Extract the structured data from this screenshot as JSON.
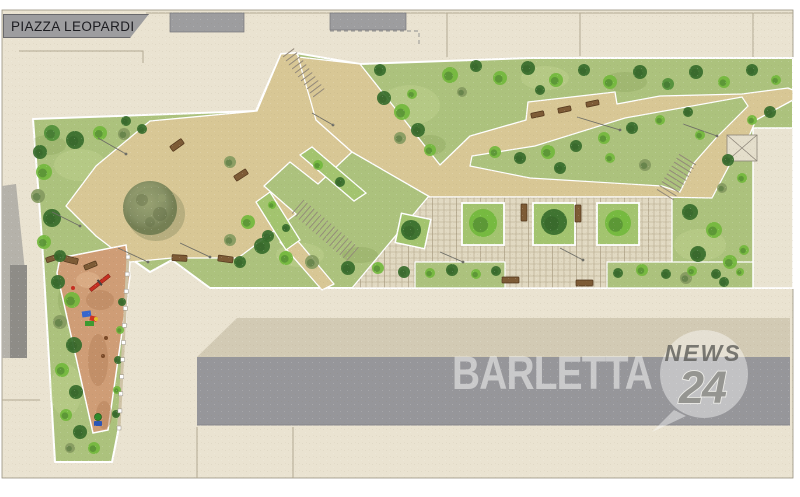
{
  "title": {
    "block_label": "PIAZZA LEOPARDI"
  },
  "watermark": {
    "brand": "BARLETTA",
    "bubble_top": "NEWS",
    "bubble_number": "24"
  },
  "colors": {
    "paper": "#eae3d1",
    "joint": "#b3a992",
    "building": "#9d9d9f",
    "building_light": "#b5b2aa",
    "building_dark": "#8e8c87",
    "band_gray": "#96969a",
    "roof_shade": "#d2cab4",
    "lawn": "#acc27d",
    "lawn_light": "#c6d795",
    "lawn_dark": "#8aa45c",
    "path": "#d8c795",
    "cobble": "#e1d9c2",
    "cobble_line": "#b6aa8d",
    "planter": "#a3c46f",
    "playground": "#cf9d76",
    "playground_dark": "#b5815a",
    "bench": "#7d5b36",
    "bench_dark": "#52371c",
    "tree_bright": "#72b93c",
    "tree_mid": "#4f8f38",
    "tree_dark": "#366d2b",
    "tree_olive": "#849a60",
    "tree_shadow": "#2f5a26",
    "big_tree": "#75865c",
    "parcel": "#e9e3d1",
    "wm_white": "#fafaf8",
    "wm_gray": "#5a5a56",
    "wm_num": "#8c8c86"
  },
  "map": {
    "trees": [
      [
        52,
        133,
        8,
        1
      ],
      [
        75,
        140,
        9,
        2
      ],
      [
        100,
        133,
        7,
        0
      ],
      [
        124,
        134,
        6,
        3
      ],
      [
        142,
        129,
        5,
        2
      ],
      [
        126,
        121,
        5,
        2
      ],
      [
        40,
        152,
        7,
        2
      ],
      [
        44,
        172,
        8,
        0
      ],
      [
        38,
        196,
        7,
        3
      ],
      [
        52,
        218,
        9,
        2
      ],
      [
        44,
        242,
        7,
        0
      ],
      [
        60,
        256,
        6,
        2
      ],
      [
        230,
        162,
        6,
        3
      ],
      [
        268,
        236,
        6,
        2
      ],
      [
        58,
        282,
        7,
        2
      ],
      [
        72,
        300,
        8,
        0
      ],
      [
        60,
        322,
        7,
        3
      ],
      [
        74,
        345,
        8,
        2
      ],
      [
        62,
        370,
        7,
        0
      ],
      [
        76,
        392,
        7,
        2
      ],
      [
        66,
        415,
        6,
        0
      ],
      [
        80,
        432,
        7,
        2
      ],
      [
        94,
        448,
        6,
        0
      ],
      [
        70,
        448,
        5,
        3
      ],
      [
        122,
        302,
        4,
        2
      ],
      [
        120,
        330,
        4,
        0
      ],
      [
        118,
        360,
        4,
        2
      ],
      [
        117,
        390,
        4,
        0
      ],
      [
        116,
        414,
        4,
        2
      ],
      [
        248,
        222,
        7,
        0
      ],
      [
        262,
        246,
        8,
        2
      ],
      [
        286,
        258,
        7,
        0
      ],
      [
        312,
        262,
        7,
        3
      ],
      [
        348,
        268,
        7,
        2
      ],
      [
        378,
        268,
        6,
        0
      ],
      [
        404,
        272,
        6,
        2
      ],
      [
        240,
        262,
        6,
        2
      ],
      [
        230,
        240,
        6,
        3
      ],
      [
        384,
        98,
        7,
        2
      ],
      [
        402,
        112,
        8,
        0
      ],
      [
        418,
        130,
        7,
        2
      ],
      [
        430,
        150,
        6,
        0
      ],
      [
        400,
        138,
        6,
        3
      ],
      [
        412,
        94,
        5,
        0
      ],
      [
        380,
        70,
        6,
        2
      ],
      [
        450,
        75,
        8,
        0
      ],
      [
        476,
        66,
        6,
        2
      ],
      [
        500,
        78,
        7,
        0
      ],
      [
        528,
        68,
        7,
        2
      ],
      [
        556,
        80,
        7,
        0
      ],
      [
        584,
        70,
        6,
        2
      ],
      [
        610,
        82,
        7,
        0
      ],
      [
        640,
        72,
        7,
        2
      ],
      [
        668,
        84,
        6,
        1
      ],
      [
        696,
        72,
        7,
        2
      ],
      [
        724,
        82,
        6,
        0
      ],
      [
        752,
        70,
        6,
        2
      ],
      [
        776,
        80,
        5,
        0
      ],
      [
        462,
        92,
        5,
        3
      ],
      [
        540,
        90,
        5,
        2
      ],
      [
        495,
        152,
        6,
        0
      ],
      [
        520,
        158,
        6,
        2
      ],
      [
        548,
        152,
        7,
        0
      ],
      [
        576,
        146,
        6,
        2
      ],
      [
        604,
        138,
        6,
        0
      ],
      [
        632,
        128,
        6,
        2
      ],
      [
        660,
        120,
        5,
        0
      ],
      [
        688,
        112,
        5,
        2
      ],
      [
        700,
        135,
        5,
        0
      ],
      [
        645,
        165,
        6,
        3
      ],
      [
        560,
        168,
        6,
        2
      ],
      [
        610,
        158,
        5,
        0
      ],
      [
        728,
        160,
        6,
        2
      ],
      [
        742,
        178,
        5,
        0
      ],
      [
        722,
        188,
        5,
        3
      ],
      [
        770,
        112,
        6,
        2
      ],
      [
        752,
        120,
        5,
        0
      ],
      [
        690,
        212,
        8,
        2
      ],
      [
        714,
        230,
        8,
        0
      ],
      [
        698,
        254,
        8,
        2
      ],
      [
        730,
        262,
        7,
        0
      ],
      [
        686,
        278,
        6,
        3
      ],
      [
        724,
        282,
        5,
        2
      ],
      [
        744,
        250,
        5,
        0
      ],
      [
        430,
        273,
        5,
        0
      ],
      [
        452,
        270,
        6,
        2
      ],
      [
        476,
        274,
        5,
        0
      ],
      [
        496,
        271,
        5,
        2
      ],
      [
        618,
        273,
        5,
        2
      ],
      [
        642,
        270,
        6,
        0
      ],
      [
        666,
        274,
        5,
        2
      ],
      [
        692,
        271,
        5,
        0
      ],
      [
        716,
        274,
        5,
        2
      ],
      [
        740,
        272,
        4,
        0
      ],
      [
        318,
        165,
        5,
        0
      ],
      [
        340,
        182,
        5,
        2
      ],
      [
        272,
        205,
        4,
        0
      ],
      [
        286,
        228,
        4,
        2
      ],
      [
        483,
        223,
        14,
        0
      ],
      [
        554,
        222,
        13,
        2
      ],
      [
        618,
        223,
        13,
        0
      ],
      [
        411,
        230,
        10,
        2
      ]
    ],
    "benches": [
      [
        64,
        257,
        14,
        6,
        14
      ],
      [
        172,
        255,
        15,
        6,
        3
      ],
      [
        218,
        256,
        15,
        6,
        8
      ],
      [
        170,
        142,
        14,
        6,
        -36
      ],
      [
        234,
        172,
        14,
        6,
        -33
      ],
      [
        46,
        256,
        12,
        5,
        -18
      ],
      [
        84,
        263,
        13,
        5,
        -22
      ],
      [
        531,
        112,
        13,
        5,
        -12
      ],
      [
        558,
        107,
        13,
        5,
        -12
      ],
      [
        586,
        101,
        13,
        5,
        -12
      ],
      [
        521,
        204,
        6,
        17,
        0
      ],
      [
        575,
        205,
        6,
        17,
        0
      ],
      [
        502,
        277,
        17,
        6,
        0
      ],
      [
        576,
        280,
        17,
        6,
        0
      ]
    ],
    "lamps": [
      [
        98,
        138,
        126,
        154
      ],
      [
        52,
        212,
        80,
        226
      ],
      [
        118,
        248,
        148,
        262
      ],
      [
        180,
        243,
        210,
        257
      ],
      [
        312,
        113,
        333,
        125
      ],
      [
        440,
        252,
        463,
        262
      ],
      [
        560,
        248,
        583,
        260
      ],
      [
        683,
        124,
        717,
        136
      ],
      [
        577,
        117,
        620,
        130
      ]
    ],
    "fence": {
      "x1": 128,
      "y1": 257,
      "x2": 119,
      "y2": 428,
      "count": 11
    }
  }
}
